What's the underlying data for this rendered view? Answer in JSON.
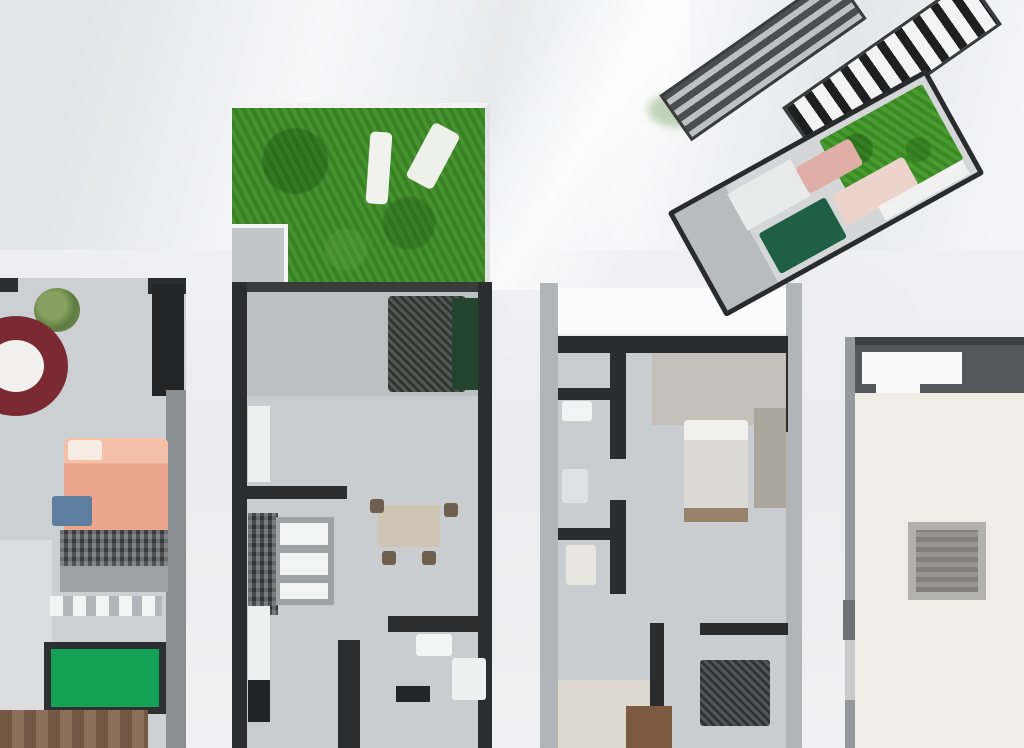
{
  "scene": {
    "title": "Apartment floor plan renders",
    "description": "Four cropped top-down rendered floor plan strips of narrow apartment units beside each other, with a tilted 3D isometric stack of two floor plates in the upper right, on a light crumpled-paper style background",
    "background_color": "#ebebed",
    "image_size": {
      "width": 1024,
      "height": 748
    },
    "visible_text": []
  },
  "palette": {
    "background": "#ebebed",
    "wall_dark": "#2c2d2f",
    "wall_light_gray": "#b2b5b7",
    "floor_gray": "#c9cdd0",
    "floor_beige": "#efede6",
    "garden_green": "#3e8d26",
    "pool_table_green": "#13a156",
    "dark_hedge_green": "#1e5f45",
    "bed_salmon": "#eca68e",
    "round_rug_dark_red": "#7b2a33",
    "wood_brown": "#82644e",
    "roof_solar_white": "#f3f3f3",
    "roof_gray": "#6f7375"
  },
  "units": [
    {
      "id": "unit-1",
      "name": "Left unit (cropped at image edge)",
      "features": [
        "potted plant",
        "dark-red round rug with white table",
        "salmon double bed with pillows",
        "blue cushion",
        "dark dresser",
        "closet with white doors",
        "green pool table",
        "wood deck strip at bottom"
      ]
    },
    {
      "id": "unit-2",
      "name": "Garden unit",
      "features": [
        "green lawn garden with two white sun loungers",
        "gray patio corner",
        "terrace with dark outdoor furniture and hedge",
        "kitchen with white cabinet row",
        "dining table with chairs",
        "hallway",
        "bathroom with white fixtures"
      ]
    },
    {
      "id": "unit-3",
      "name": "Center unit",
      "features": [
        "white balcony band at top",
        "two small bathrooms on the left",
        "bedroom with bed, bench and wardrobe",
        "hallway",
        "beige room bottom left",
        "dark dining set",
        "brown cabinet at bottom"
      ]
    },
    {
      "id": "unit-4",
      "name": "Right unit (cropped at image edge)",
      "features": [
        "dark header band with white window",
        "large empty beige floor",
        "gray square rug",
        "left wall with door"
      ]
    }
  ],
  "render_3d": {
    "name": "Isometric stacked floor plates",
    "elements": [
      "dark gray striped roof slab",
      "white slab with black solar-panel stripes",
      "floor plate with bright green lawn, dark green hedge, pink furniture and gray rooms"
    ],
    "rotation_deg": -30
  }
}
